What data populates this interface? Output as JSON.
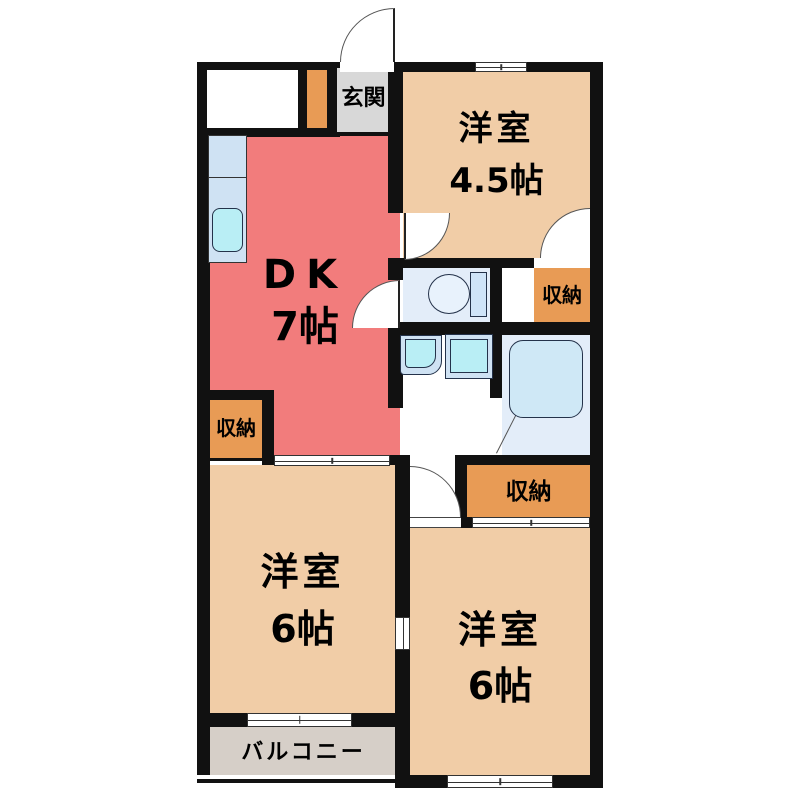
{
  "floorplan": {
    "title": "2DK apartment floor plan",
    "entrance": {
      "label": "玄関"
    },
    "room_45": {
      "name": "洋室",
      "size": "4.5帖"
    },
    "dk": {
      "name": "DK",
      "size": "7帖"
    },
    "storage": {
      "label": "収納"
    },
    "room_6_left": {
      "name": "洋室",
      "size": "6帖"
    },
    "room_6_right": {
      "name": "洋室",
      "size": "6帖"
    },
    "balcony": {
      "label": "バルコニー"
    },
    "fixtures": [
      "kitchen-counter",
      "kitchen-sink",
      "toilet",
      "washbasin",
      "washing-machine-pan",
      "bathtub"
    ],
    "colors": {
      "wall": "#111111",
      "dk_fill": "#f27c7c",
      "room_fill": "#f1cda7",
      "storage_fill": "#e89b55",
      "entrance_fill": "#d8d8d8",
      "balcony_fill": "#d6cfc8",
      "wet_room_fill": "#e3edf9",
      "fixture_fill": "#cfe2f3",
      "sink_fill": "#b9eef5"
    }
  }
}
